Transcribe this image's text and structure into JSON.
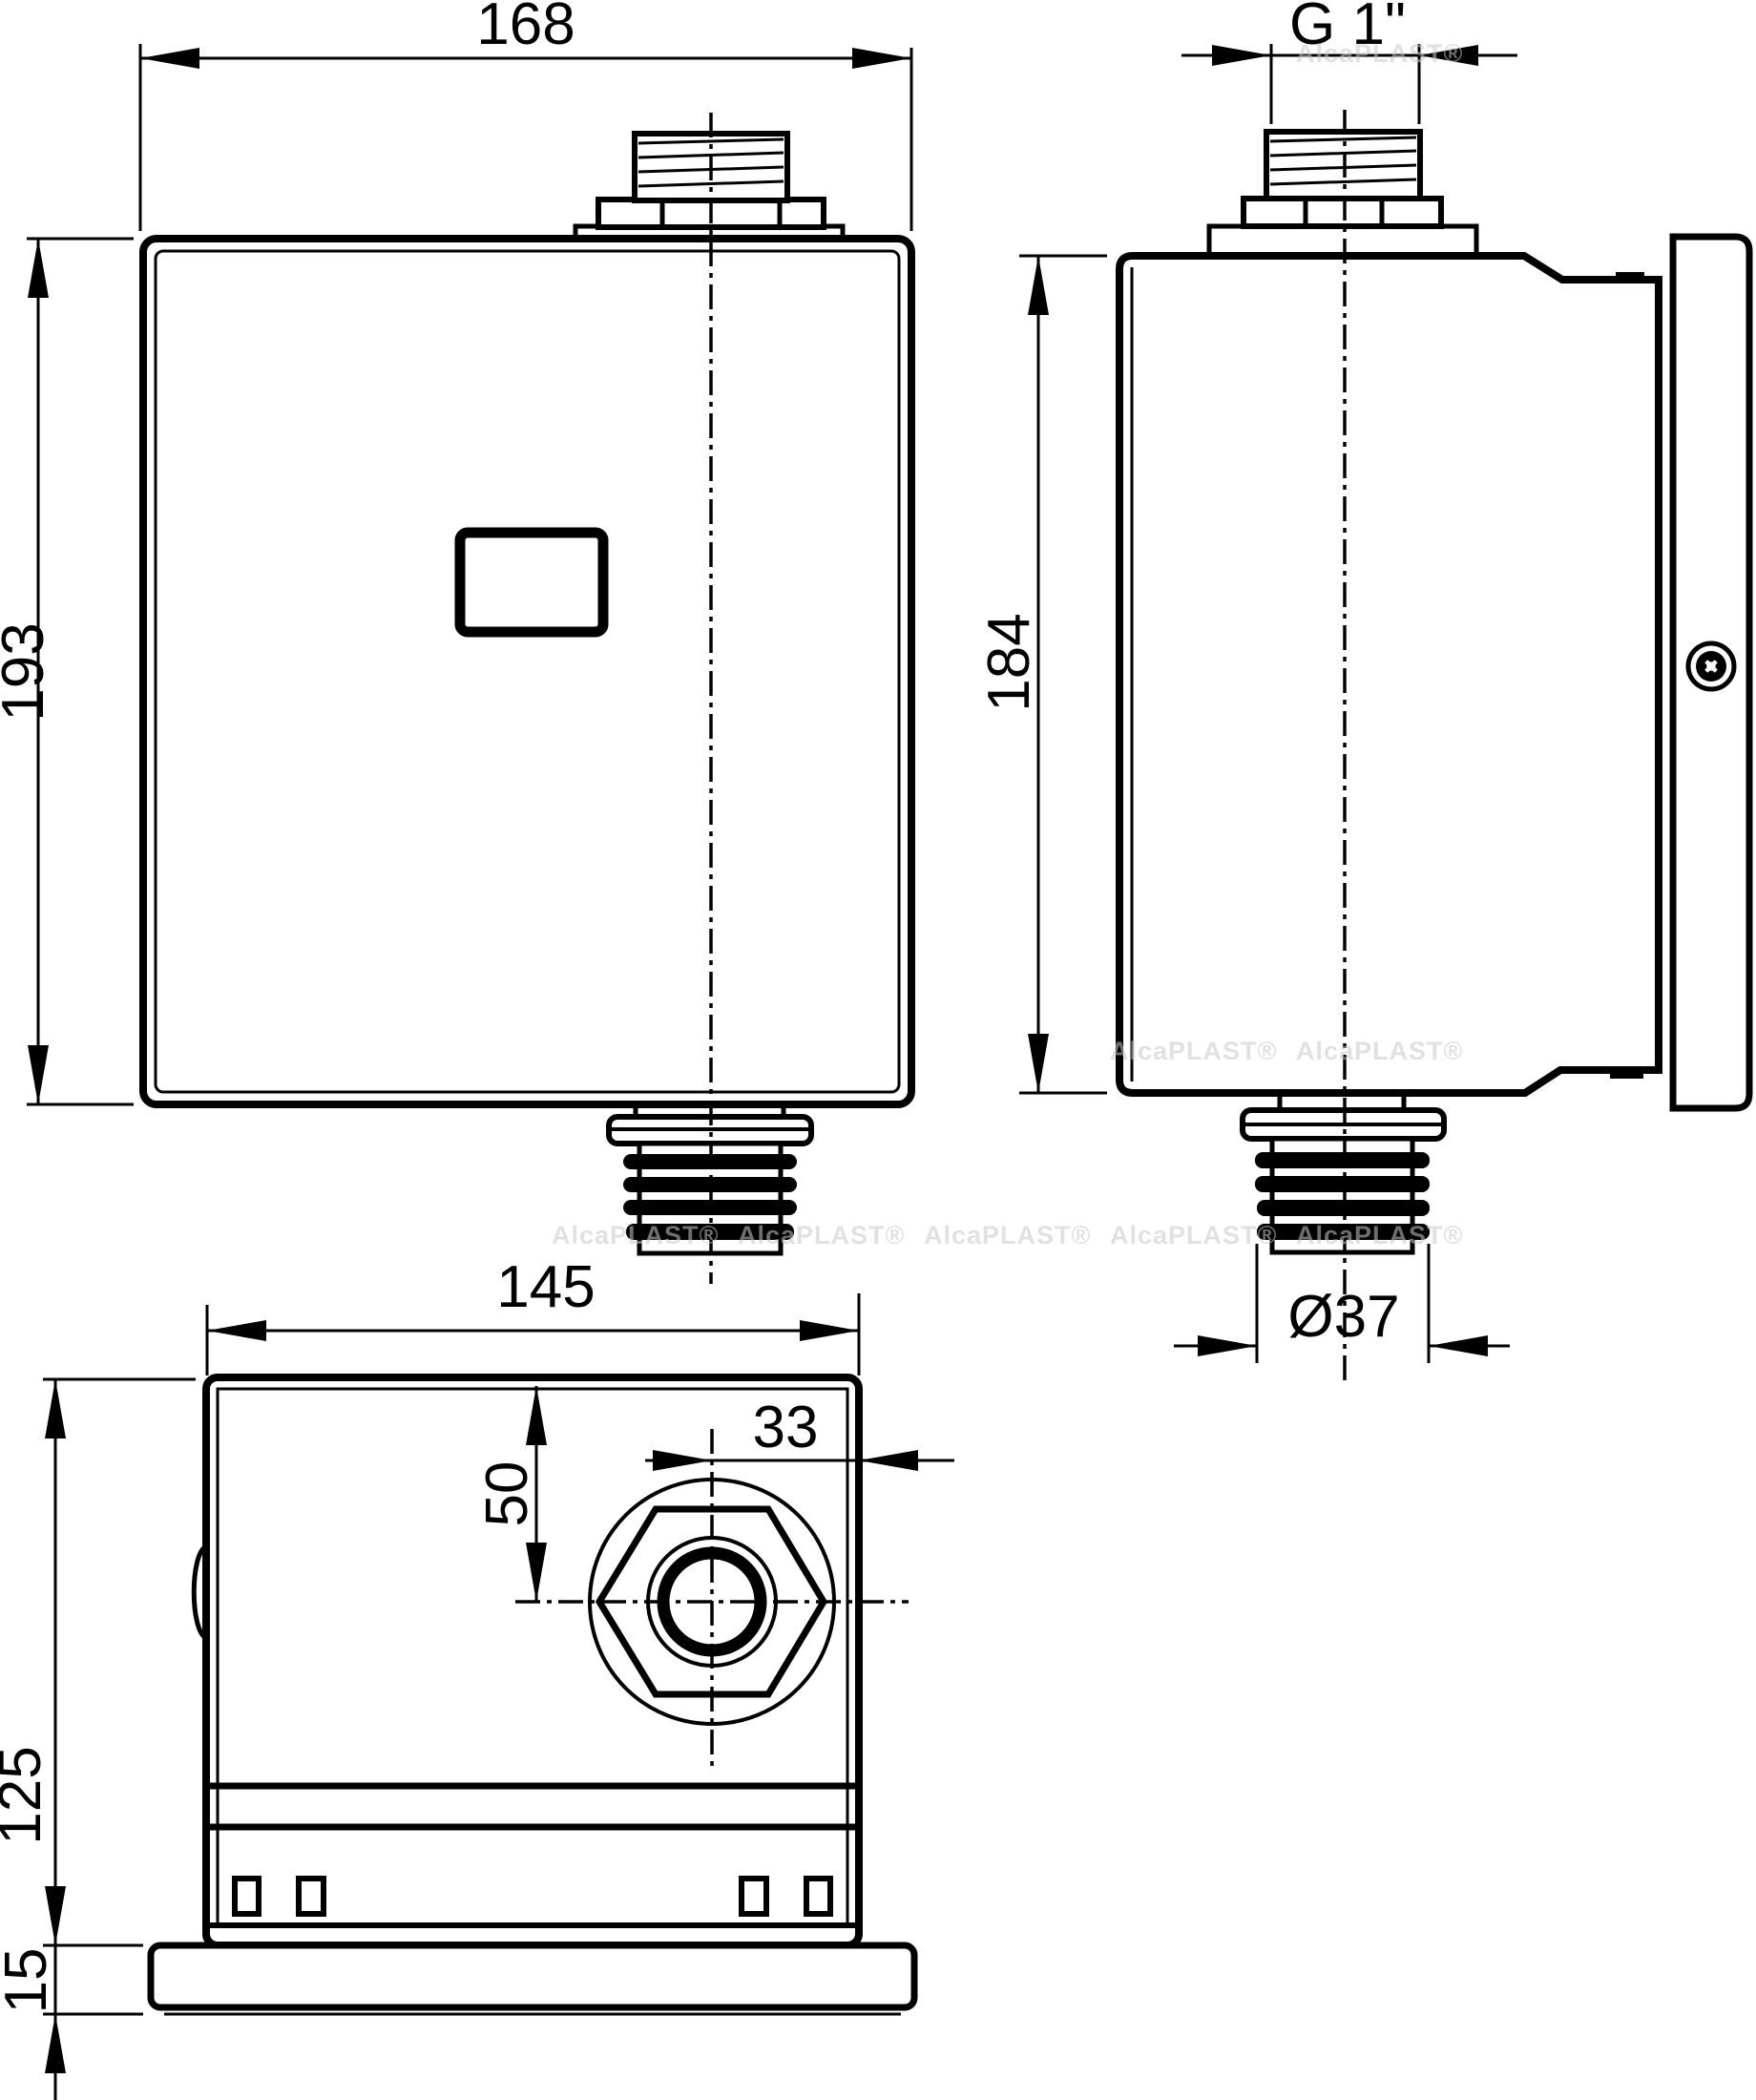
{
  "drawing": {
    "type": "technical-orthographic-views",
    "background_color": "#ffffff",
    "line_color": "#000000",
    "watermark": {
      "text": "AlcaPLAST®",
      "color": "#c9c9c9"
    },
    "views": {
      "front": {
        "name": "front-view",
        "dimensions": {
          "width": {
            "label": "168"
          },
          "height": {
            "label": "193"
          }
        },
        "features": [
          "top-thread-connector",
          "sensor-window",
          "bottom-ribbed-outlet",
          "centerline"
        ]
      },
      "side": {
        "name": "side-view",
        "dimensions": {
          "thread": {
            "label": "G 1\""
          },
          "height": {
            "label": "184"
          },
          "outlet_diameter": {
            "label": "Ø37"
          }
        },
        "features": [
          "top-thread-connector",
          "wall-mount-plate",
          "mount-clips",
          "screw",
          "bottom-ribbed-outlet",
          "centerline"
        ]
      },
      "bottom": {
        "name": "bottom-view",
        "dimensions": {
          "width": {
            "label": "145"
          },
          "outlet_offset_x": {
            "label": "33"
          },
          "outlet_offset_y": {
            "label": "50"
          },
          "depth": {
            "label": "125"
          },
          "flange_thickness": {
            "label": "15"
          }
        },
        "features": [
          "hex-nut-outlet",
          "outer-circle",
          "mount-clips",
          "base-flange",
          "crosshair-centerlines"
        ]
      }
    }
  }
}
